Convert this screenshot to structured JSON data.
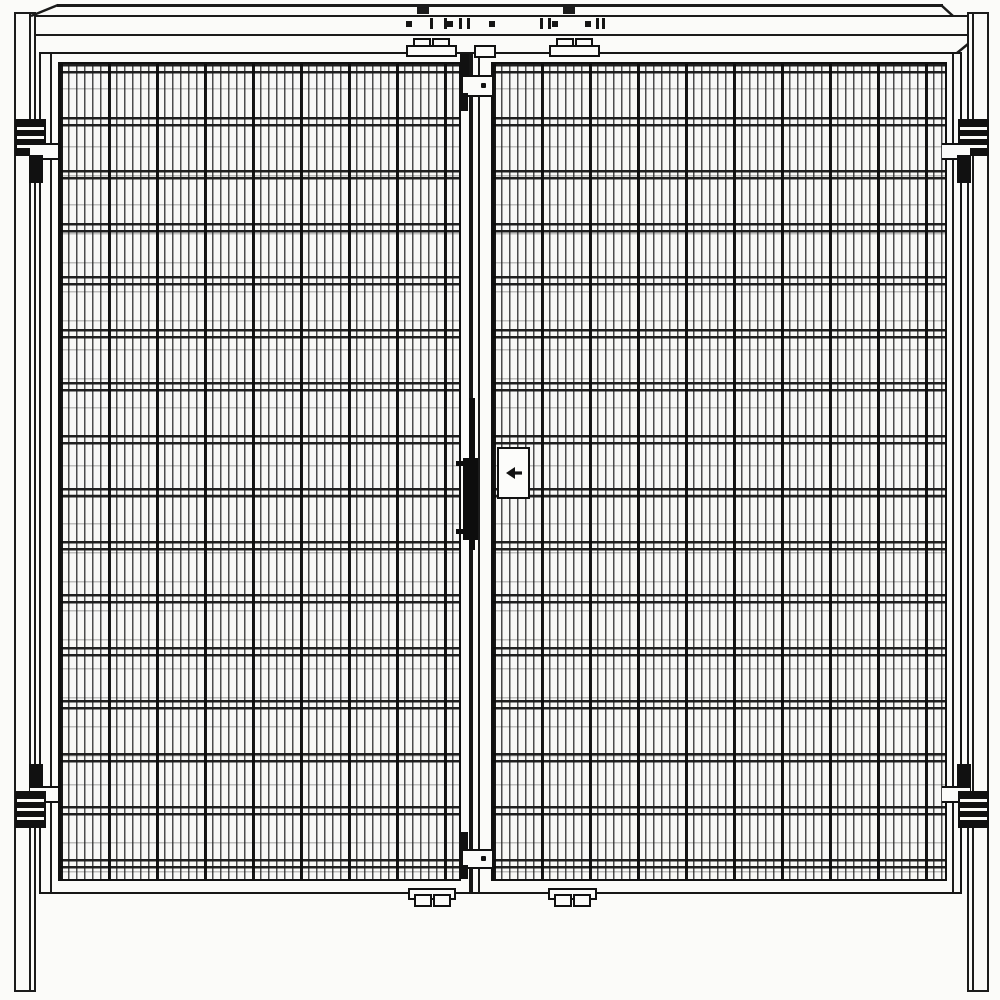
{
  "diagram": {
    "subject": "Technical line drawing: double-door wire mesh safety gate, front elevation",
    "style": "black-and-white CAD line drawing, no text or dimensions shown",
    "background_color": "#fbfbf9",
    "line_color": "#1b1b1b",
    "counts": {
      "door_leaves": 2,
      "hinges": 4,
      "side_posts": 2,
      "hanger_brackets_top": 2,
      "foot_brackets_bottom": 2,
      "latch_keepers_center": 2
    },
    "icons": {
      "lock_plate_symbol": "arrow-left-icon"
    },
    "mesh": {
      "vertical_wire_spacing_px": 8,
      "heavy_vertical_wire_spacing_px": 48,
      "horizontal_wire_pair_spacing_px": 53,
      "horizontal_pair_gap_px": 7
    }
  }
}
